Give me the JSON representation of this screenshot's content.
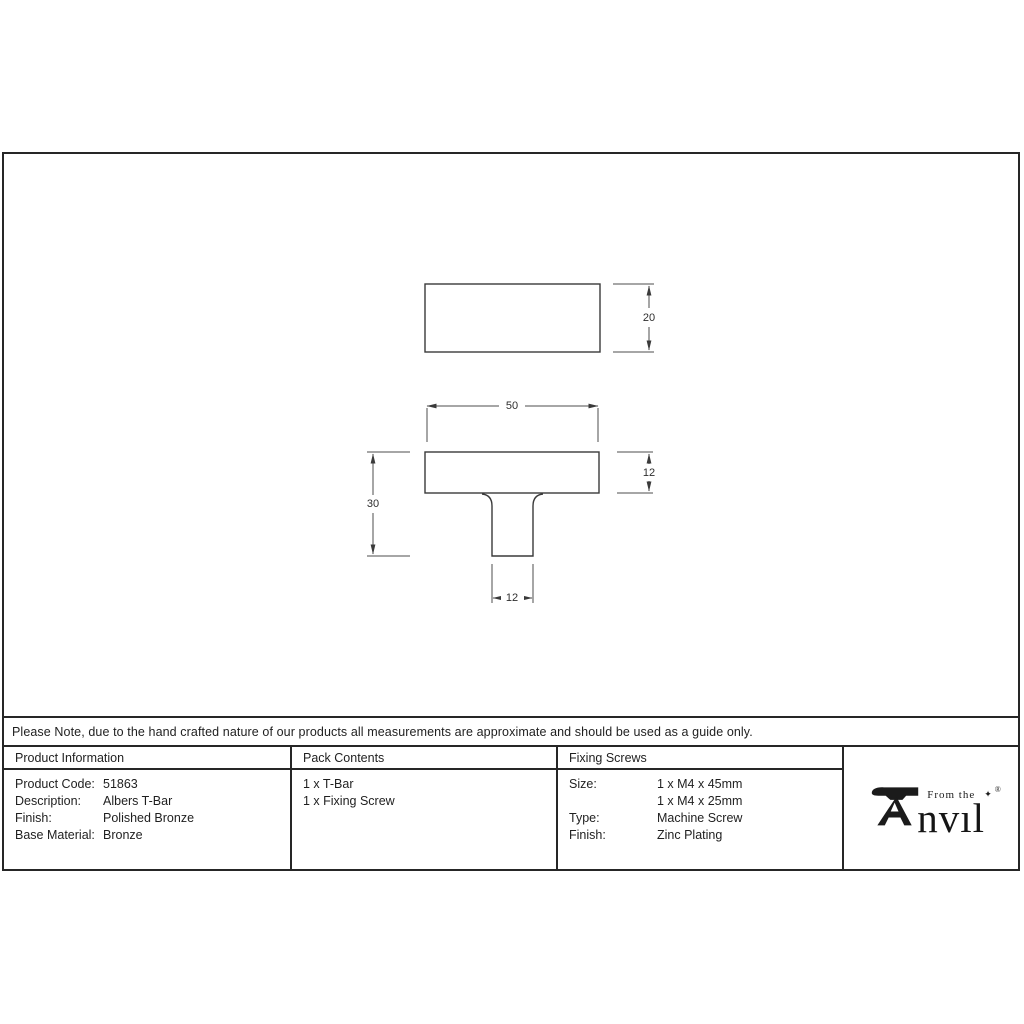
{
  "colors": {
    "frame": "#262626",
    "drawing_line": "#3a3a3a",
    "dim_line": "#4c4c4c",
    "background": "#ffffff"
  },
  "note": {
    "text": "Please Note, due to the hand crafted nature of our products all measurements are approximate and should be used as a guide only."
  },
  "drawing": {
    "top_view": {
      "depth": "20"
    },
    "front_view": {
      "width": "50",
      "head_height": "12",
      "overall_height": "30",
      "stem_width": "12"
    }
  },
  "table": {
    "product_information": {
      "header": "Product Information",
      "rows": [
        {
          "label": "Product Code:",
          "value": "51863"
        },
        {
          "label": "Description:",
          "value": "Albers T-Bar"
        },
        {
          "label": "Finish:",
          "value": "Polished Bronze"
        },
        {
          "label": "Base Material:",
          "value": "Bronze"
        }
      ]
    },
    "pack_contents": {
      "header": "Pack Contents",
      "items": [
        "1 x T-Bar",
        "1 x Fixing Screw"
      ]
    },
    "fixing_screws": {
      "header": "Fixing Screws",
      "rows": [
        {
          "label": "Size:",
          "value": "1 x M4 x 45mm"
        },
        {
          "label": "",
          "value": "1 x M4 x 25mm"
        },
        {
          "label": "Type:",
          "value": "Machine Screw"
        },
        {
          "label": "Finish:",
          "value": "Zinc Plating"
        }
      ]
    }
  },
  "logo": {
    "word": "Anvil",
    "from_the": "From the",
    "nvil_display": "nvıl",
    "star": "✦",
    "registered": "®"
  }
}
